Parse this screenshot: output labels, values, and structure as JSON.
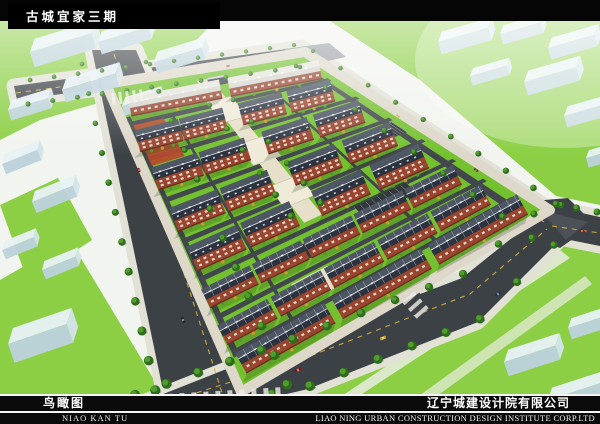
{
  "banner": {
    "title": "古城宜家三期"
  },
  "footer": {
    "view_label_cn": "鸟瞰图",
    "view_label_en": "NIAO KAN TU",
    "company_cn": "辽宁城建设计院有限公司",
    "company_en": "LIAO NING URBAN CONSTRUCTION DESIGN INSTITUTE CORP.LTD"
  },
  "scene": {
    "kind": "aerial-architectural-rendering",
    "subject": "bird's-eye view of a walled residential community with rows of red-brick apartment blocks, central pedestrian plaza, perimeter tree-lined roads and surrounding massing-model buildings",
    "colors": {
      "band": "#050505",
      "text": "#ffffff",
      "base": "#f2f4ef",
      "grass_out": "#8ccf44",
      "grass_site": "#74c12f",
      "road": "#3c4146",
      "road_in": "#42474d",
      "road_line": "#d9b43a",
      "pavement": "#e2e1d6",
      "roof_front": "#2c3340",
      "roof_back": "#4d5663",
      "ridge": "#e8eaee",
      "brick": "#9a4530",
      "brick_dark": "#6e2d1d",
      "window": "#ece6d8",
      "plaza": "#e6dfca",
      "plaza_light": "#f0ead9",
      "ctx_top": "#e7f2f5",
      "ctx_front": "#bcd2dc",
      "ctx_side": "#d2e4ea",
      "tree_dark": "#2e6b1d",
      "tree_light": "#4f9d2a",
      "courtyard": "#b5492c"
    }
  }
}
